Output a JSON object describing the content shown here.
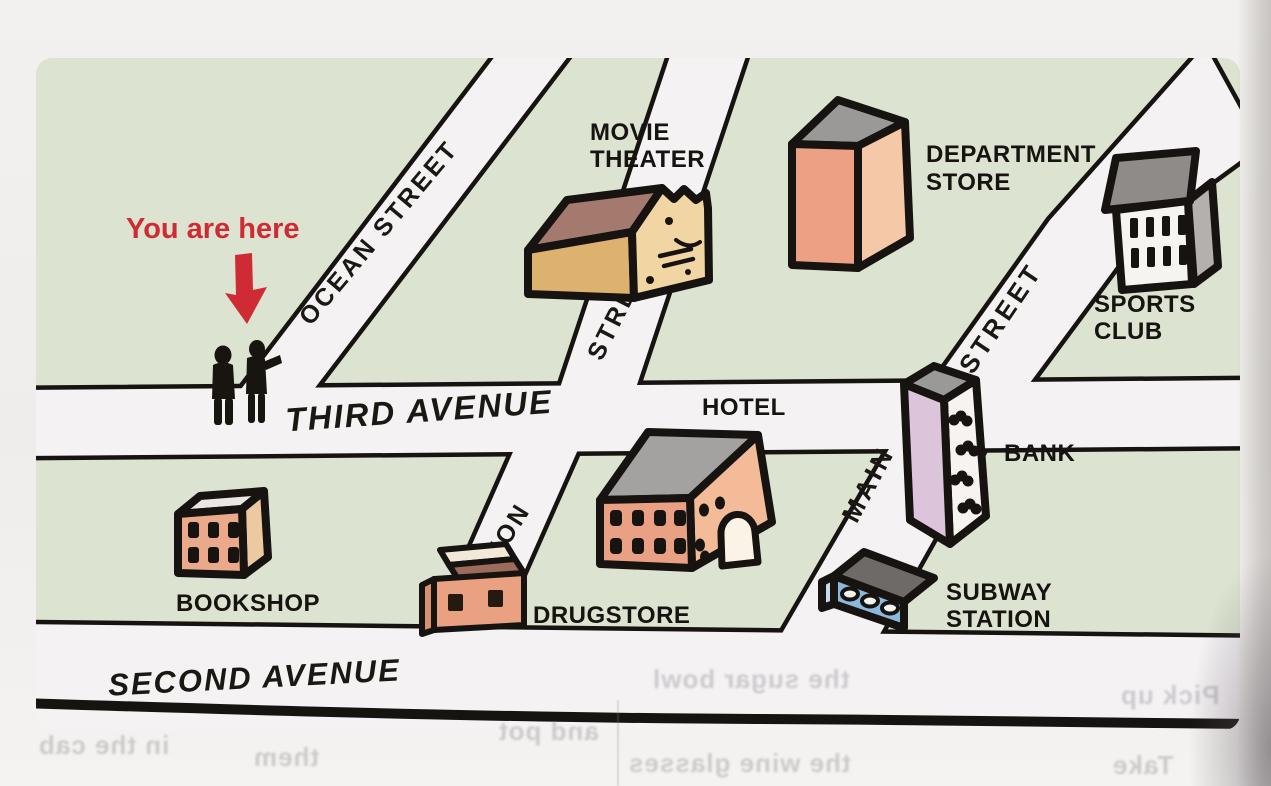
{
  "marker": {
    "label": "You are here"
  },
  "streets": {
    "ocean": "OCEAN STREET",
    "cross_street": "STREET",
    "union": "UNION",
    "main": "MAIN",
    "main_street_suffix": "STREET",
    "third_avenue": "THIRD AVENUE",
    "second_avenue": "SECOND AVENUE"
  },
  "buildings": {
    "movie_theater": {
      "line1": "MOVIE",
      "line2": "THEATER"
    },
    "department_store": {
      "line1": "DEPARTMENT",
      "line2": "STORE"
    },
    "sports_club": {
      "line1": "SPORTS",
      "line2": "CLUB"
    },
    "hotel": {
      "label": "HOTEL"
    },
    "bank": {
      "label": "BANK"
    },
    "subway_station": {
      "line1": "SUBWAY",
      "line2": "STATION"
    },
    "drugstore": {
      "label": "DRUGSTORE"
    },
    "bookshop": {
      "label": "BOOKSHOP"
    }
  },
  "page_showthrough": {
    "pick_up": "Pick up",
    "take": "Take",
    "them": "them",
    "in_the_cab": "in the cab",
    "and_pot": "and pot",
    "the_sugar_bowl": "the sugar bowl",
    "the_wine_glasses": "the wine glasses"
  },
  "colors": {
    "marker_red": "#cf2b35",
    "map_green": "#dce3d0",
    "street_white": "#f5f2f4",
    "ink_black": "#171310",
    "building_salmon": "#eca084",
    "building_tan": "#dcb26e",
    "building_lilac": "#dcc4da",
    "building_blue": "#8cb8dc",
    "roof_gray": "#9b9998"
  }
}
